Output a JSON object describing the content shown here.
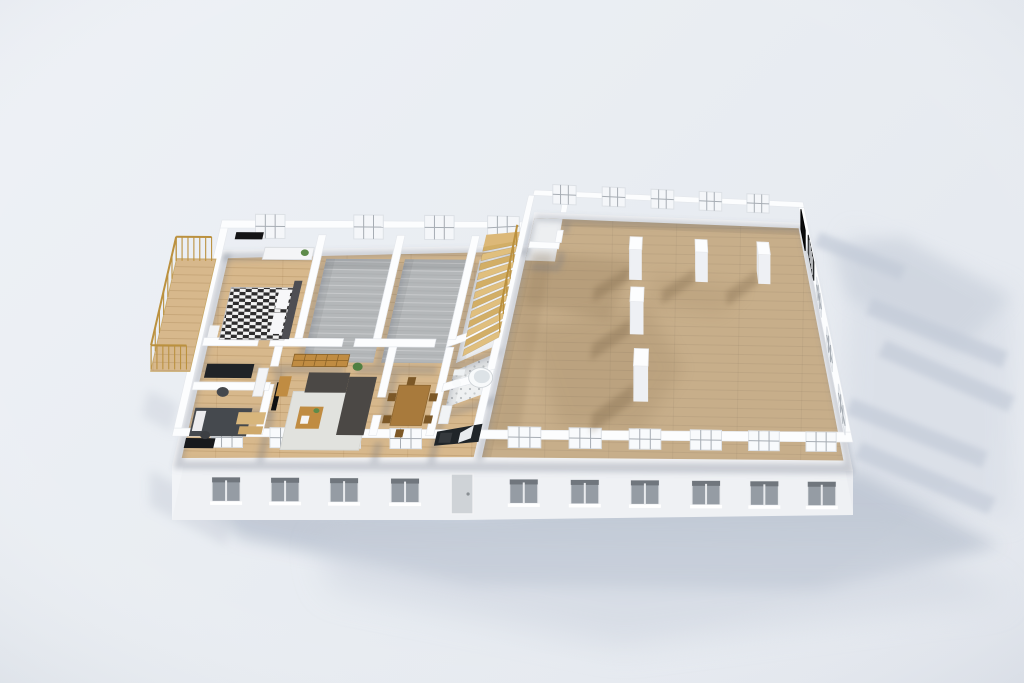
{
  "meta": {
    "kind": "3d-floorplan-render"
  },
  "palette": {
    "bg_light": "#eef1f6",
    "bg_dark": "#e3e7ee",
    "wall_top": "#fcfdfe",
    "wall_stroke": "#e4e7ec",
    "wall_base": "rgba(105,115,132,0.30)",
    "floor_plate": "#f2f3f5",
    "facade": "#eff1f4",
    "facade_west": "#f2f4f7",
    "facade_east": "#ebedf1",
    "glass": "#959ca4",
    "lintel": "#70767d",
    "sill": "#ffffff",
    "panel_fill": "#f8fafc",
    "panel_stroke": "#dde1e6",
    "mullion": "#a7adb4",
    "wood": "#d7b88c",
    "wood_line": "rgba(120,80,30,0.16)",
    "tan": "#c7ae8a",
    "tan_line": "rgba(0,0,0,0.05)",
    "gray_floor": "#b4b7b9",
    "gray_line": "rgba(255,255,255,0.25)",
    "tile": "#eff1f2",
    "tile_dot": "#b9bdc0",
    "white_floor": "#edeff1",
    "column_top": "#fcfdfe",
    "column_south": "#eef0f4",
    "column_west": "#e3e6eb",
    "interior_shadow": "#7a6344",
    "ground_shadow": "#bfc7d4",
    "stair_a": "#e0bf7e",
    "stair_b": "#d2ae66",
    "landing": "#dcb878",
    "rail": "#bb913f",
    "black_panel": "#0b0b0d",
    "grille_dark": "#303236",
    "grille_line": "#d8dadd"
  },
  "projection": {
    "split_u": 300,
    "left": {
      "origin": [
        172,
        466
      ],
      "eu": [
        0.98333,
        0.006667
      ],
      "nv": [
        0.23256,
        -1.00465
      ]
    },
    "right": {
      "quad": [
        [
          467,
          468
        ],
        [
          853,
          471
        ],
        [
          803,
          223
        ],
        [
          527,
          212
        ]
      ],
      "u0": 300,
      "u_span": 390,
      "v_span": 260
    }
  },
  "plan": {
    "length": 690,
    "depth": 260
  },
  "footprint": [
    [
      0,
      0
    ],
    [
      690,
      0
    ],
    [
      690,
      260
    ],
    [
      310,
      260
    ],
    [
      310,
      215
    ],
    [
      0,
      215
    ]
  ],
  "facade": {
    "left_h": 54,
    "mid_h": 52,
    "right_h": 44,
    "mid_u": 295,
    "west_h1": 54,
    "west_h2": 34,
    "east_h1": 40,
    "east_h2": 26
  },
  "floors": [
    {
      "n": "left-wing-floor",
      "r": [
        8,
        8,
        304,
        207
      ],
      "fk": "wood",
      "shade": false
    },
    {
      "n": "room-gray-a",
      "r": [
        108,
        104,
        180,
        207
      ],
      "fk": "gray",
      "shade": true
    },
    {
      "n": "room-gray-b",
      "r": [
        188,
        104,
        256,
        207
      ],
      "fk": "gray",
      "shade": true
    },
    {
      "n": "room-stairwell",
      "r": [
        264,
        104,
        304,
        207
      ],
      "fk": "white",
      "shade": true
    },
    {
      "n": "room-bathroom",
      "r": [
        264,
        60,
        304,
        96
      ],
      "fk": "tile",
      "shade": true
    },
    {
      "n": "room-great-hall",
      "r": [
        312,
        8,
        682,
        252
      ],
      "fk": "tan",
      "shade": true
    },
    {
      "n": "hall-vestibule",
      "r": [
        312,
        196,
        350,
        252
      ],
      "fk": "white",
      "shade": false
    }
  ],
  "walls": {
    "ext": [
      [
        0,
        0,
        690,
        8
      ],
      [
        0,
        8,
        8,
        215
      ],
      [
        0,
        207,
        312,
        215
      ],
      [
        310,
        252,
        690,
        260
      ],
      [
        682,
        8,
        690,
        252
      ],
      [
        304,
        8,
        312,
        252
      ]
    ],
    "int": [
      [
        8,
        96,
        64,
        104
      ],
      [
        76,
        96,
        150,
        104
      ],
      [
        162,
        96,
        244,
        104
      ],
      [
        256,
        96,
        304,
        104
      ],
      [
        100,
        104,
        108,
        207
      ],
      [
        180,
        104,
        188,
        207
      ],
      [
        256,
        104,
        264,
        207
      ],
      [
        82,
        8,
        90,
        58
      ],
      [
        82,
        76,
        90,
        96
      ],
      [
        8,
        52,
        86,
        60
      ],
      [
        198,
        8,
        206,
        28
      ],
      [
        198,
        46,
        206,
        96
      ],
      [
        256,
        8,
        264,
        96
      ],
      [
        262,
        52,
        310,
        60
      ],
      [
        318,
        188,
        356,
        196
      ],
      [
        350,
        196,
        358,
        212
      ],
      [
        350,
        236,
        358,
        252
      ]
    ]
  },
  "windows": {
    "south_u": [
      55,
      115,
      175,
      237,
      355,
      415,
      475,
      537,
      597,
      657
    ],
    "door_u": 295,
    "north_left_u": [
      50,
      150,
      222,
      286
    ],
    "north_right_u": [
      352,
      420,
      488,
      556,
      624
    ],
    "east_v": [
      30,
      85,
      140
    ],
    "grilles_v": [
      [
        170,
        205
      ]
    ],
    "black_panel_v": [
      215,
      245
    ]
  },
  "columns": {
    "pos": [
      [
        455,
        185
      ],
      [
        540,
        185
      ],
      [
        622,
        185
      ],
      [
        460,
        125
      ],
      [
        468,
        62
      ]
    ],
    "half": 8,
    "h": 38,
    "shadow_dir": [
      -43,
      -27
    ]
  },
  "stairs": {
    "u1": 270,
    "u2": 302,
    "v0": 108,
    "steps": 12,
    "dv": 7.8,
    "l0": 3,
    "dl": 1.7,
    "landing": [
      270,
      198,
      302,
      210
    ],
    "rail_u": 302
  },
  "balcony": {
    "floor": [
      -44,
      94,
      -4,
      206
    ],
    "rails": [
      [
        [
          -44,
          96
        ],
        [
          -44,
          204
        ]
      ],
      [
        [
          -44,
          96
        ],
        [
          -8,
          96
        ]
      ],
      [
        [
          -44,
          204
        ],
        [
          -8,
          204
        ]
      ]
    ]
  },
  "furniture": [
    {
      "t": "rect",
      "n": "bed-duvet-checker",
      "r": [
        20,
        118,
        86,
        170
      ],
      "f": "url(#checker)",
      "s": "#bdbdbf",
      "l": 8
    },
    {
      "t": "rect",
      "n": "bed-headboard",
      "r": [
        84,
        114,
        92,
        172
      ],
      "f": "#4e4e53",
      "l": 13
    },
    {
      "t": "rect",
      "n": "bed-pillow",
      "r": [
        70,
        122,
        82,
        143
      ],
      "f": "#f7f7f9",
      "l": 10
    },
    {
      "t": "rect",
      "n": "bed-pillow",
      "r": [
        70,
        147,
        82,
        166
      ],
      "f": "#f7f7f9",
      "l": 10
    },
    {
      "t": "rect",
      "n": "nightstand",
      "r": [
        8,
        118,
        18,
        130
      ],
      "f": "#f2f3f5",
      "l": 10
    },
    {
      "t": "rect",
      "n": "dresser",
      "r": [
        46,
        194,
        96,
        206
      ],
      "f": "#f4f5f7",
      "s": "#d9dce0",
      "l": 12
    },
    {
      "t": "circle",
      "n": "plant",
      "c": [
        88,
        199
      ],
      "rad": 4,
      "f": "#5e8b4a",
      "l": 14
    },
    {
      "t": "rect",
      "n": "wall-tv",
      "r": [
        16,
        202,
        44,
        209
      ],
      "f": "#141416",
      "l": 24
    },
    {
      "t": "rect",
      "n": "office-desk",
      "r": [
        14,
        78,
        62,
        92
      ],
      "f": "#202327",
      "l": 10
    },
    {
      "t": "circle",
      "n": "office-chair",
      "c": [
        36,
        66
      ],
      "rad": 6,
      "f": "#45484d",
      "l": 8
    },
    {
      "t": "rect",
      "n": "office-shelf",
      "r": [
        68,
        58,
        78,
        86
      ],
      "f": "#f3f4f6",
      "s": "#d9dce0",
      "l": 12
    },
    {
      "t": "rect",
      "n": "bed-dark",
      "r": [
        12,
        22,
        70,
        50
      ],
      "f": "#45494e",
      "l": 8
    },
    {
      "t": "rect",
      "n": "bed-dark-pillow",
      "r": [
        14,
        26,
        24,
        46
      ],
      "f": "#ececee",
      "l": 9
    },
    {
      "t": "rect",
      "n": "small-desk",
      "r": [
        10,
        8,
        40,
        18
      ],
      "f": "#17191c",
      "l": 10
    },
    {
      "t": "circle",
      "n": "small-chair",
      "c": [
        28,
        24
      ],
      "rad": 5,
      "f": "#3c3f43",
      "l": 7
    },
    {
      "t": "rect",
      "n": "wood-boards",
      "r": [
        56,
        38,
        84,
        50
      ],
      "f": "#d8b67c",
      "l": 4
    },
    {
      "t": "rect",
      "n": "wood-boards",
      "r": [
        60,
        29,
        84,
        37
      ],
      "f": "#cfa96b",
      "l": 3
    },
    {
      "t": "rect",
      "n": "rug",
      "r": [
        106,
        16,
        186,
        74
      ],
      "f": "#e1e2de",
      "s": "#d4d5d1",
      "l": 1
    },
    {
      "t": "rect",
      "n": "sofa",
      "r": [
        162,
        20,
        190,
        78
      ],
      "f": "#4b4845",
      "l": 12
    },
    {
      "t": "rect",
      "n": "sofa",
      "r": [
        120,
        62,
        162,
        82
      ],
      "f": "#4b4845",
      "l": 12
    },
    {
      "t": "rect",
      "n": "coffee-table",
      "r": [
        118,
        30,
        142,
        52
      ],
      "f": "#c08c42",
      "l": 8
    },
    {
      "t": "rect",
      "n": "magazine",
      "r": [
        122,
        34,
        130,
        42
      ],
      "f": "#f5f5f5",
      "l": 9
    },
    {
      "t": "circle",
      "n": "plant",
      "c": [
        136,
        46
      ],
      "rad": 3,
      "f": "#5e8b4a",
      "l": 10
    },
    {
      "t": "rect",
      "n": "tv",
      "r": [
        92,
        36,
        97,
        64
      ],
      "f": "#0e0f11",
      "l": 20
    },
    {
      "t": "rect",
      "n": "tv-console",
      "r": [
        90,
        64,
        102,
        84
      ],
      "f": "#c08c42",
      "l": 6
    },
    {
      "t": "grid",
      "n": "bookshelf",
      "r": [
        102,
        84,
        158,
        96
      ],
      "f": "#c08c42",
      "s": "#8a6227",
      "l": 16,
      "cols": 5,
      "rows": 2
    },
    {
      "t": "circle",
      "n": "plant-big",
      "c": [
        168,
        88
      ],
      "rad": 5,
      "f": "#4f7f41",
      "l": 12
    },
    {
      "t": "rect",
      "n": "dining-table",
      "r": [
        214,
        32,
        246,
        72
      ],
      "f": "#a87a3c",
      "s": "#8f6730",
      "l": 10
    },
    {
      "t": "rect",
      "n": "dining-chair",
      "r": [
        205,
        36,
        213,
        44
      ],
      "f": "#7c5827",
      "l": 8
    },
    {
      "t": "rect",
      "n": "dining-chair",
      "r": [
        205,
        58,
        213,
        66
      ],
      "f": "#7c5827",
      "l": 8
    },
    {
      "t": "rect",
      "n": "dining-chair",
      "r": [
        247,
        36,
        255,
        44
      ],
      "f": "#7c5827",
      "l": 8
    },
    {
      "t": "rect",
      "n": "dining-chair",
      "r": [
        247,
        58,
        255,
        66
      ],
      "f": "#7c5827",
      "l": 8
    },
    {
      "t": "rect",
      "n": "dining-chair",
      "r": [
        221,
        22,
        229,
        30
      ],
      "f": "#7c5827",
      "l": 8
    },
    {
      "t": "rect",
      "n": "dining-chair",
      "r": [
        221,
        74,
        229,
        82
      ],
      "f": "#7c5827",
      "l": 8
    },
    {
      "t": "circle",
      "n": "bathtub",
      "c": [
        294,
        84
      ],
      "rad": 12,
      "f": "#f8fafb",
      "s": "#ccd1d5",
      "l": 6
    },
    {
      "t": "circle",
      "n": "bathtub-inner",
      "c": [
        295,
        85
      ],
      "rad": 8,
      "f": "#dde3e7",
      "l": 6
    },
    {
      "t": "circle",
      "n": "toilet",
      "c": [
        271,
        78
      ],
      "rad": 4.5,
      "f": "#f8fafb",
      "l": 6
    },
    {
      "t": "rect",
      "n": "toilet-tank",
      "r": [
        266,
        84,
        277,
        90
      ],
      "f": "#eef1f3",
      "l": 8
    },
    {
      "t": "rect",
      "n": "kitchen-counter",
      "r": [
        264,
        10,
        308,
        24
      ],
      "f": "#202529",
      "l": 12
    },
    {
      "t": "rect",
      "n": "kitchen-sink",
      "r": [
        288,
        12,
        300,
        22
      ],
      "f": "#e8ebee",
      "l": 13
    },
    {
      "t": "rect",
      "n": "stove",
      "r": [
        268,
        12,
        280,
        22
      ],
      "f": "#35393d",
      "l": 13
    },
    {
      "t": "rect",
      "n": "fridge",
      "r": [
        264,
        28,
        274,
        46
      ],
      "f": "#f1f3f5",
      "s": "#dfe2e6",
      "l": 16
    }
  ],
  "interior_shadows": [
    {
      "pts": [
        [
          320,
          208
        ],
        [
          455,
          200
        ],
        [
          425,
          132
        ],
        [
          320,
          146
        ]
      ],
      "o": 0.2,
      "b": "b8"
    },
    {
      "pts": [
        [
          330,
          120
        ],
        [
          470,
          150
        ],
        [
          515,
          84
        ],
        [
          470,
          30
        ],
        [
          385,
          32
        ]
      ],
      "o": 0.15,
      "b": "b12"
    },
    {
      "pts": [
        [
          318,
          16
        ],
        [
          344,
          16
        ],
        [
          344,
          206
        ],
        [
          318,
          206
        ]
      ],
      "o": 0.14,
      "b": "b4"
    },
    {
      "pts": [
        [
          470,
          150
        ],
        [
          560,
          140
        ],
        [
          600,
          170
        ],
        [
          480,
          185
        ]
      ],
      "o": 0.11,
      "b": "b12"
    }
  ],
  "ground_shadows": [
    {
      "pts": [
        [
          850,
          232
        ],
        [
          1010,
          292
        ],
        [
          1012,
          520
        ],
        [
          842,
          502
        ]
      ],
      "f": "#d2d8e2",
      "o": 0.5,
      "b": "b18"
    },
    {
      "pts": [
        [
          196,
          498
        ],
        [
          470,
          510
        ],
        [
          858,
          472
        ],
        [
          1000,
          546
        ],
        [
          818,
          590
        ],
        [
          470,
          584
        ],
        [
          240,
          538
        ]
      ],
      "f": "#bfc7d4",
      "o": 0.9,
      "b": "b12"
    },
    {
      "pts": [
        [
          320,
          540
        ],
        [
          900,
          538
        ],
        [
          1008,
          598
        ],
        [
          620,
          646
        ],
        [
          330,
          588
        ]
      ],
      "f": "#ccd3de",
      "o": 0.55,
      "b": "b22"
    },
    {
      "pts": [
        [
          830,
          248
        ],
        [
          902,
          236
        ],
        [
          1010,
          298
        ],
        [
          958,
          350
        ],
        [
          848,
          298
        ]
      ],
      "f": "#c9d0db",
      "o": 0.6,
      "b": "b12"
    },
    {
      "pts": [
        [
          872,
          298
        ],
        [
          1008,
          352
        ],
        [
          1002,
          368
        ],
        [
          866,
          314
        ]
      ],
      "f": "#c3cbd8",
      "o": 0.7,
      "b": "b4"
    },
    {
      "pts": [
        [
          886,
          340
        ],
        [
          1015,
          396
        ],
        [
          1008,
          412
        ],
        [
          878,
          356
        ]
      ],
      "f": "#c3cbd8",
      "o": 0.7,
      "b": "b4"
    },
    {
      "pts": [
        [
          852,
          398
        ],
        [
          988,
          452
        ],
        [
          982,
          468
        ],
        [
          846,
          414
        ]
      ],
      "f": "#c3cbd8",
      "o": 0.7,
      "b": "b4"
    },
    {
      "pts": [
        [
          862,
          442
        ],
        [
          996,
          498
        ],
        [
          988,
          514
        ],
        [
          854,
          458
        ]
      ],
      "f": "#c3cbd8",
      "o": 0.7,
      "b": "b4"
    },
    {
      "pts": [
        [
          820,
          232
        ],
        [
          906,
          266
        ],
        [
          900,
          280
        ],
        [
          814,
          246
        ]
      ],
      "f": "#c3cbd8",
      "o": 0.7,
      "b": "b4"
    },
    {
      "pts": [
        [
          148,
          390
        ],
        [
          178,
          404
        ],
        [
          172,
          432
        ],
        [
          142,
          416
        ]
      ],
      "f": "#ccd2dc",
      "o": 0.5,
      "b": "b8"
    },
    {
      "pts": [
        [
          150,
          470
        ],
        [
          232,
          514
        ],
        [
          226,
          546
        ],
        [
          150,
          506
        ]
      ],
      "f": "#ccd2dc",
      "o": 0.55,
      "b": "b8"
    }
  ]
}
